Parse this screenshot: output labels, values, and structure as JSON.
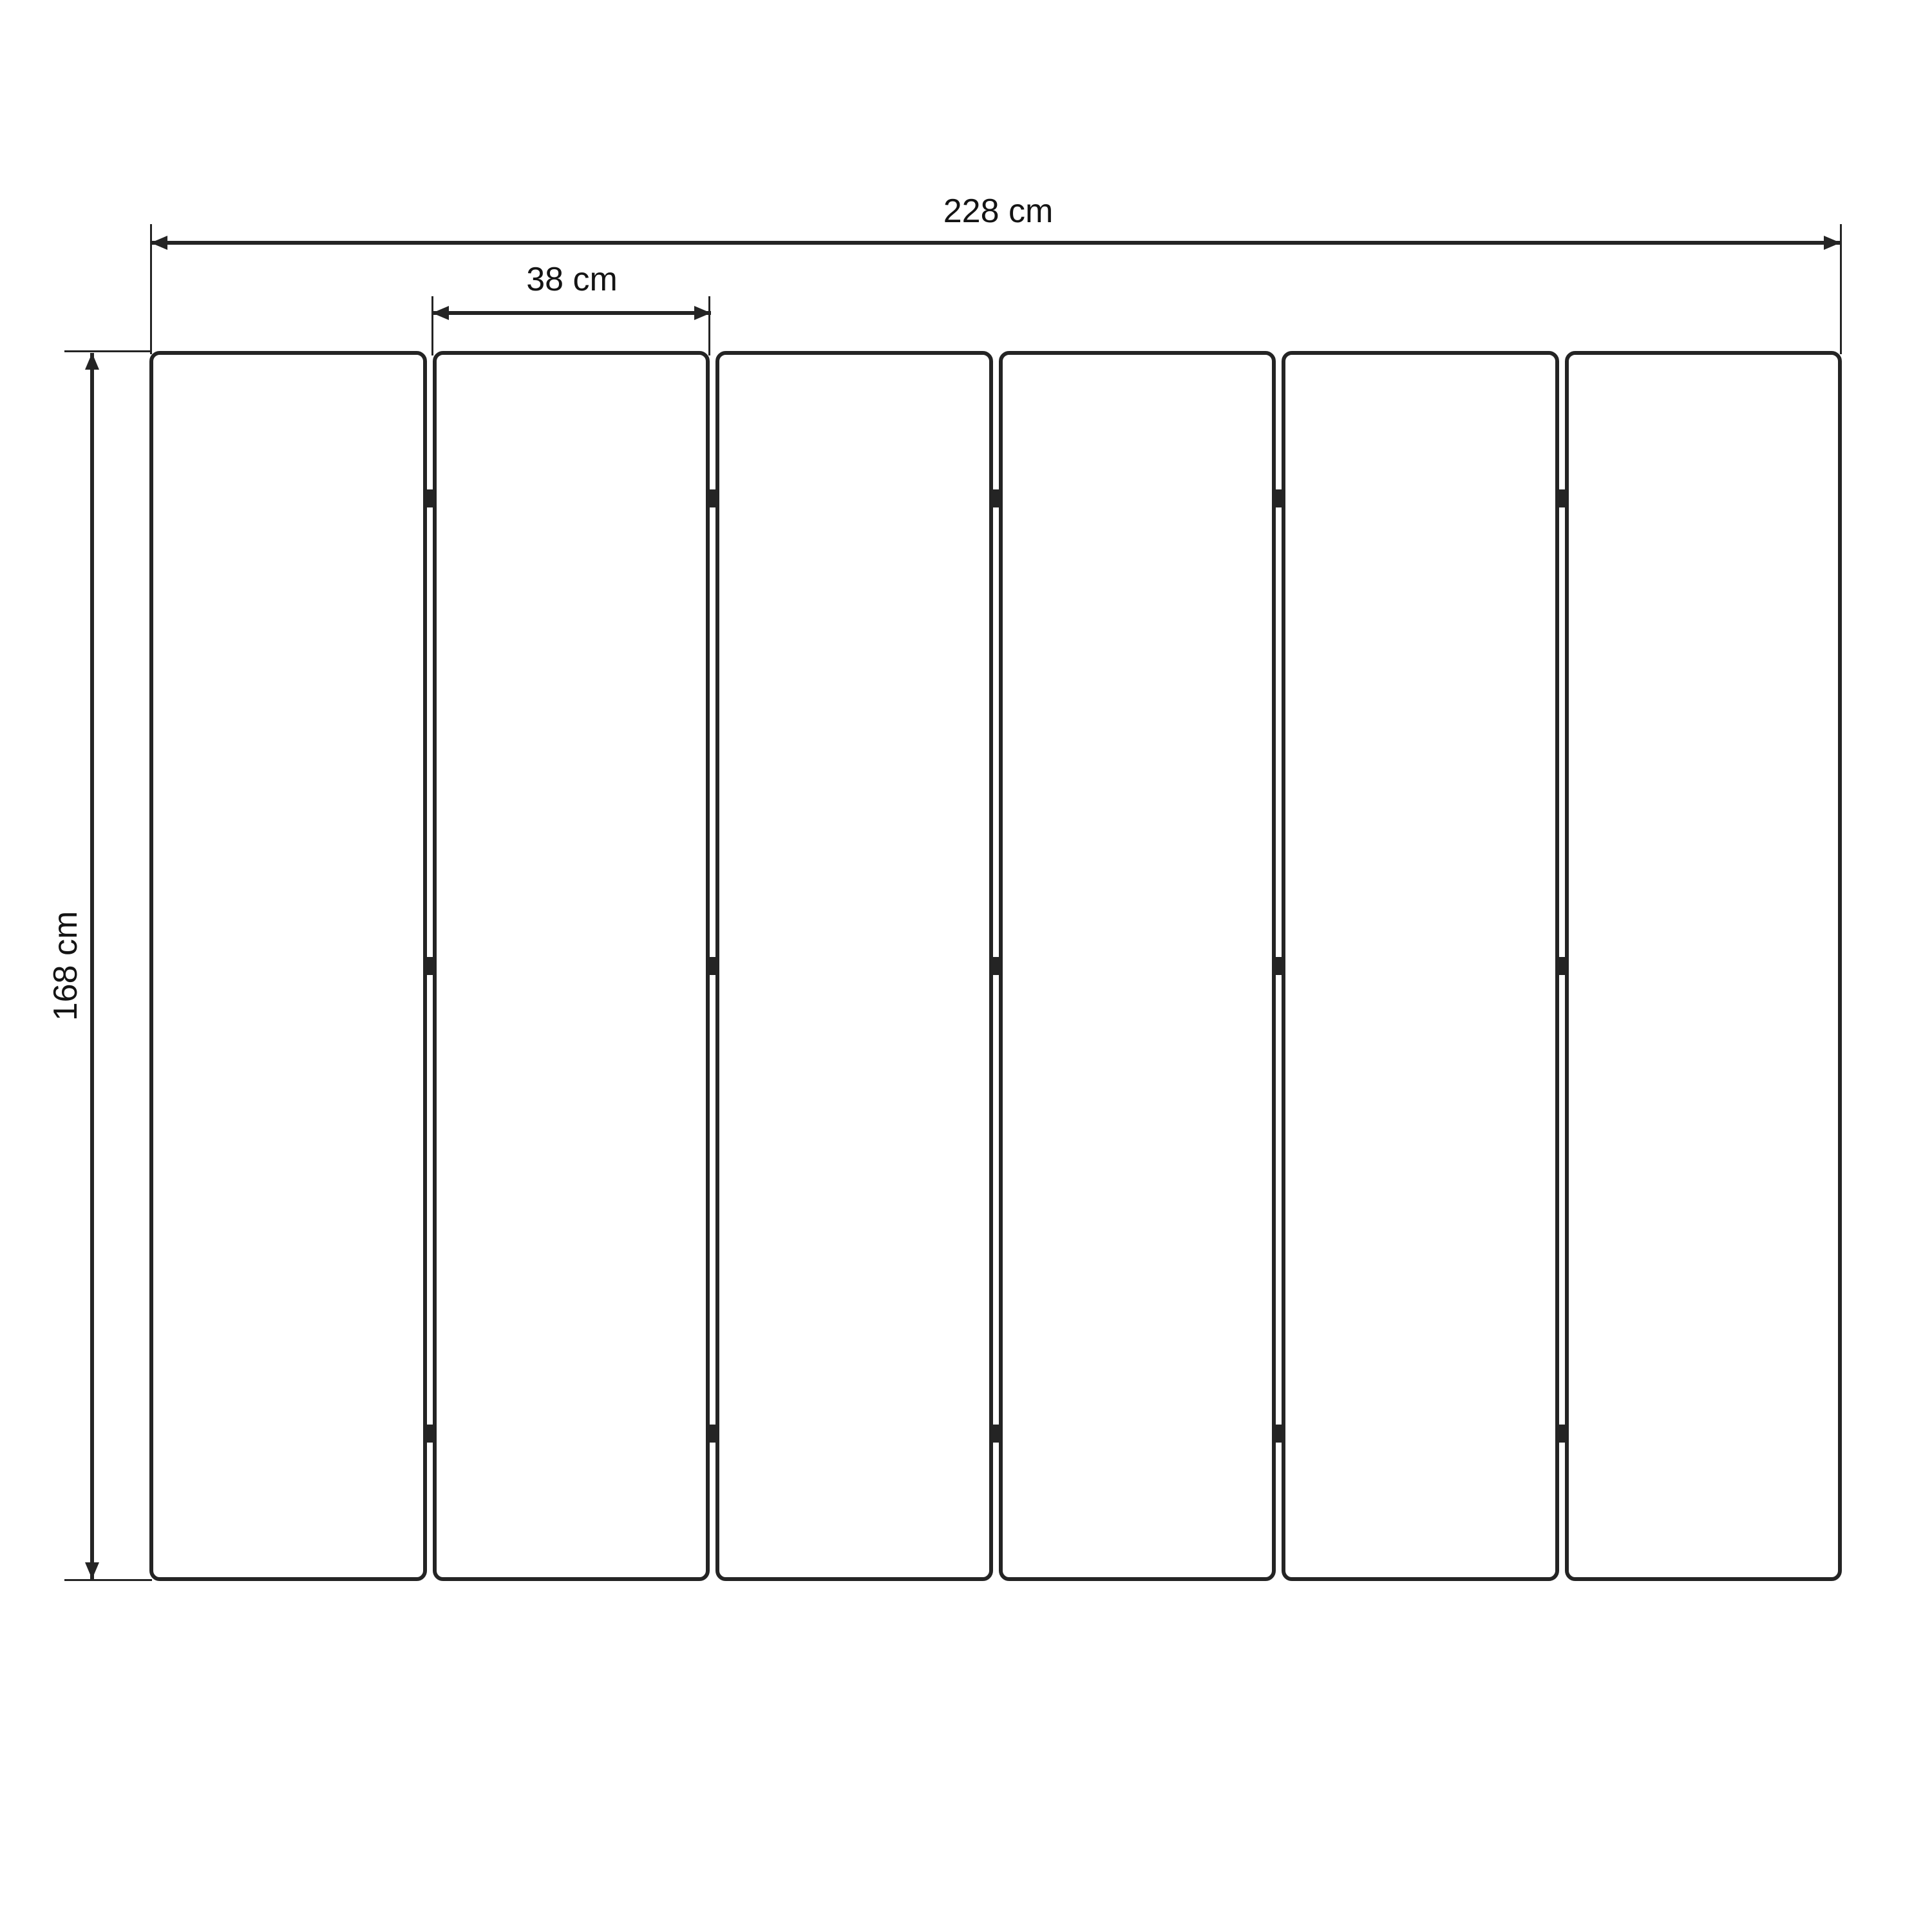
{
  "diagram": {
    "type": "dimensioned-drawing",
    "subject": "six-panel folding screen, front elevation",
    "background_color": "#ffffff",
    "line_color": "#242424",
    "text_color": "#141414",
    "panels": {
      "count": 6,
      "joint_count": 5,
      "hinges_per_joint": 3,
      "hinge_row_fractions": [
        0.12,
        0.5,
        0.88
      ]
    },
    "dimensions": {
      "total_width": {
        "label": "228 cm",
        "value": 228,
        "unit": "cm"
      },
      "panel_width": {
        "label": "38 cm",
        "value": 38,
        "unit": "cm"
      },
      "height": {
        "label": "168 cm",
        "value": 168,
        "unit": "cm"
      }
    }
  }
}
